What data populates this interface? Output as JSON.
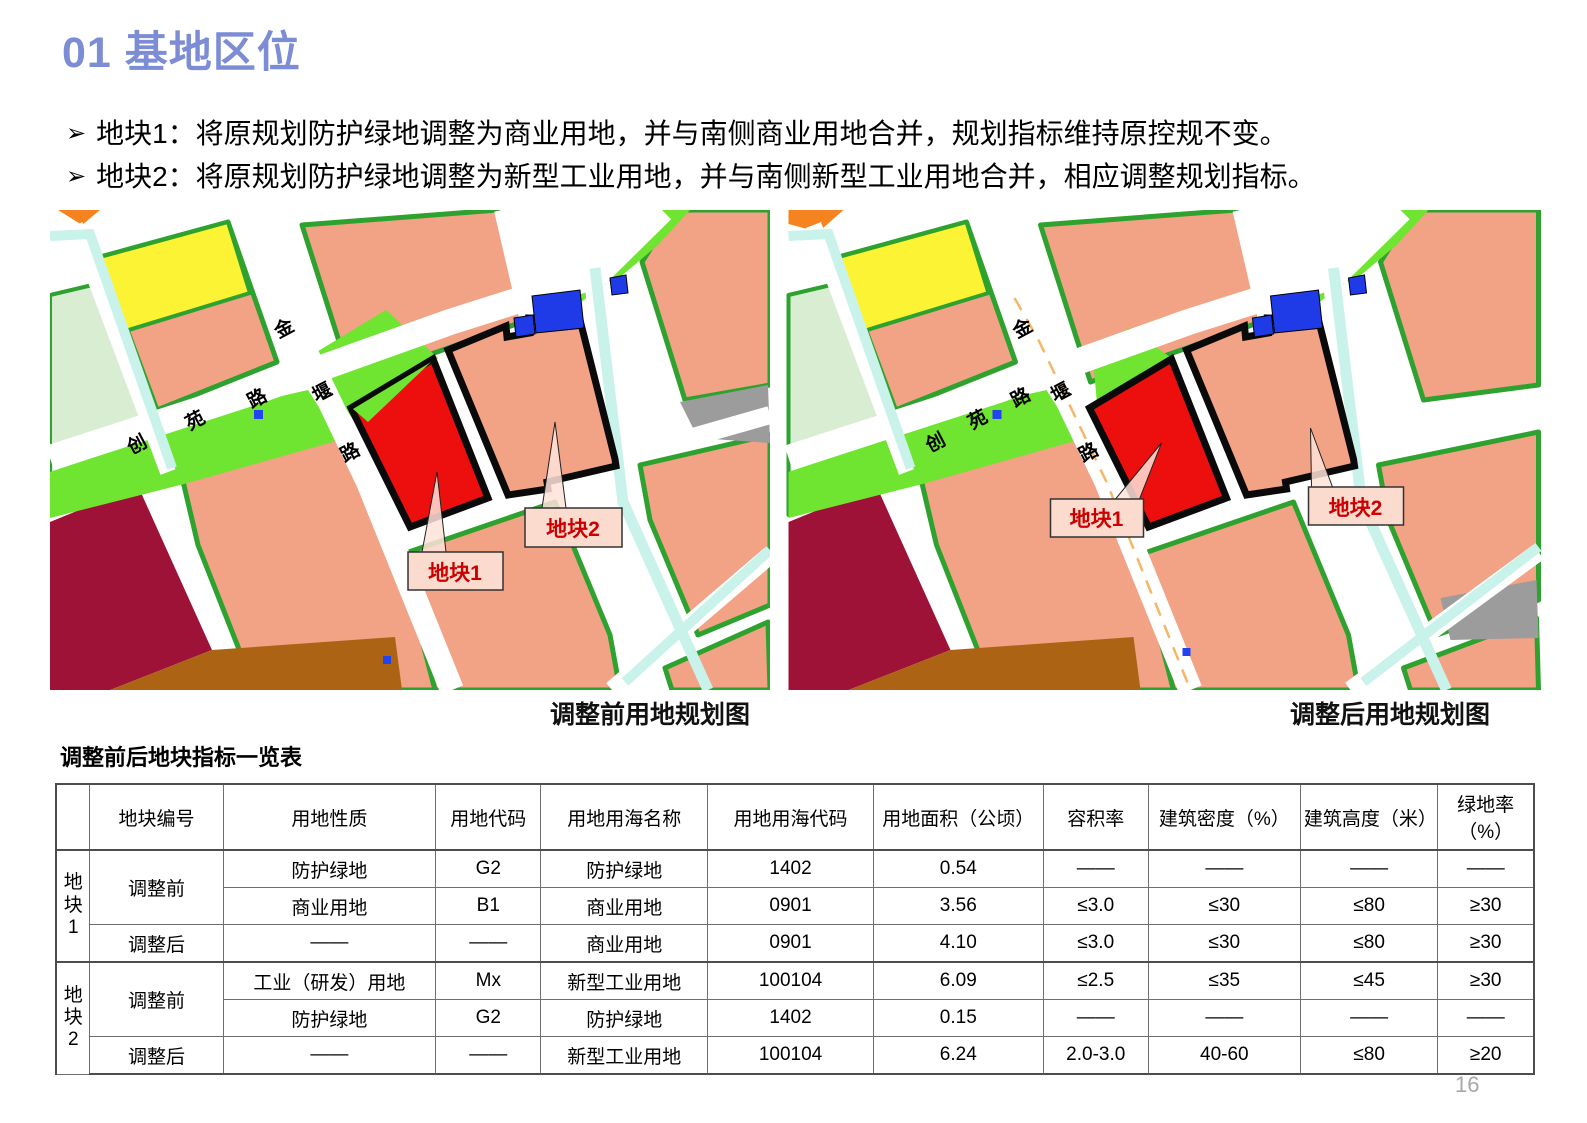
{
  "header": {
    "title": "01 基地区位"
  },
  "bullets": {
    "marker": "➢",
    "items": [
      "地块1：将原规划防护绿地调整为商业用地，并与南侧商业用地合并，规划指标维持原控规不变。",
      "地块2：将原规划防护绿地调整为新型工业用地，并与南侧新型工业用地合并，相应调整规划指标。"
    ]
  },
  "maps": {
    "before": {
      "caption": "调整前用地规划图"
    },
    "after": {
      "caption": "调整后用地规划图"
    },
    "parcel1_label": "地块1",
    "parcel2_label": "地块2",
    "road_chuangyuan": [
      "创",
      "苑",
      "路"
    ],
    "road_jinyan": [
      "金",
      "堰",
      "路"
    ]
  },
  "table": {
    "title": "调整前后地块指标一览表",
    "headers": [
      "",
      "地块编号",
      "用地性质",
      "用地代码",
      "用地用海名称",
      "用地用海代码",
      "用地面积（公顷）",
      "容积率",
      "建筑密度（%）",
      "建筑高度（米）",
      "绿地率（%）"
    ],
    "groups": [
      {
        "id": "地\n块\n1",
        "phase_before": "调整前",
        "phase_after": "调整后"
      },
      {
        "id": "地\n块\n2",
        "phase_before": "调整前",
        "phase_after": "调整后"
      }
    ],
    "rows": [
      [
        "防护绿地",
        "G2",
        "防护绿地",
        "1402",
        "0.54",
        "——",
        "——",
        "——",
        "——"
      ],
      [
        "商业用地",
        "B1",
        "商业用地",
        "0901",
        "3.56",
        "≤3.0",
        "≤30",
        "≤80",
        "≥30"
      ],
      [
        "——",
        "——",
        "商业用地",
        "0901",
        "4.10",
        "≤3.0",
        "≤30",
        "≤80",
        "≥30"
      ],
      [
        "工业（研发）用地",
        "Mx",
        "新型工业用地",
        "100104",
        "6.09",
        "≤2.5",
        "≤35",
        "≤45",
        "≥30"
      ],
      [
        "防护绿地",
        "G2",
        "防护绿地",
        "1402",
        "0.15",
        "——",
        "——",
        "——",
        "——"
      ],
      [
        "——",
        "——",
        "新型工业用地",
        "100104",
        "6.24",
        "2.0-3.0",
        "40-60",
        "≤80",
        "≥20"
      ]
    ]
  },
  "page": {
    "number": "16"
  },
  "colors": {
    "accent": "#7C8CD5",
    "salmon": "#F2A285",
    "chartreuse": "#6FE431",
    "parcel-red": "#ED0E0E",
    "label-red": "#CC0000",
    "block-green-stroke": "#2EA22E",
    "yellow-block": "#FDF335",
    "maroon-block": "#9E1237",
    "brown-block": "#AC6414",
    "cyan-channel": "#C9F2EA",
    "blue-block": "#1F3BE8",
    "dashed-centerline": "#F7B665"
  }
}
